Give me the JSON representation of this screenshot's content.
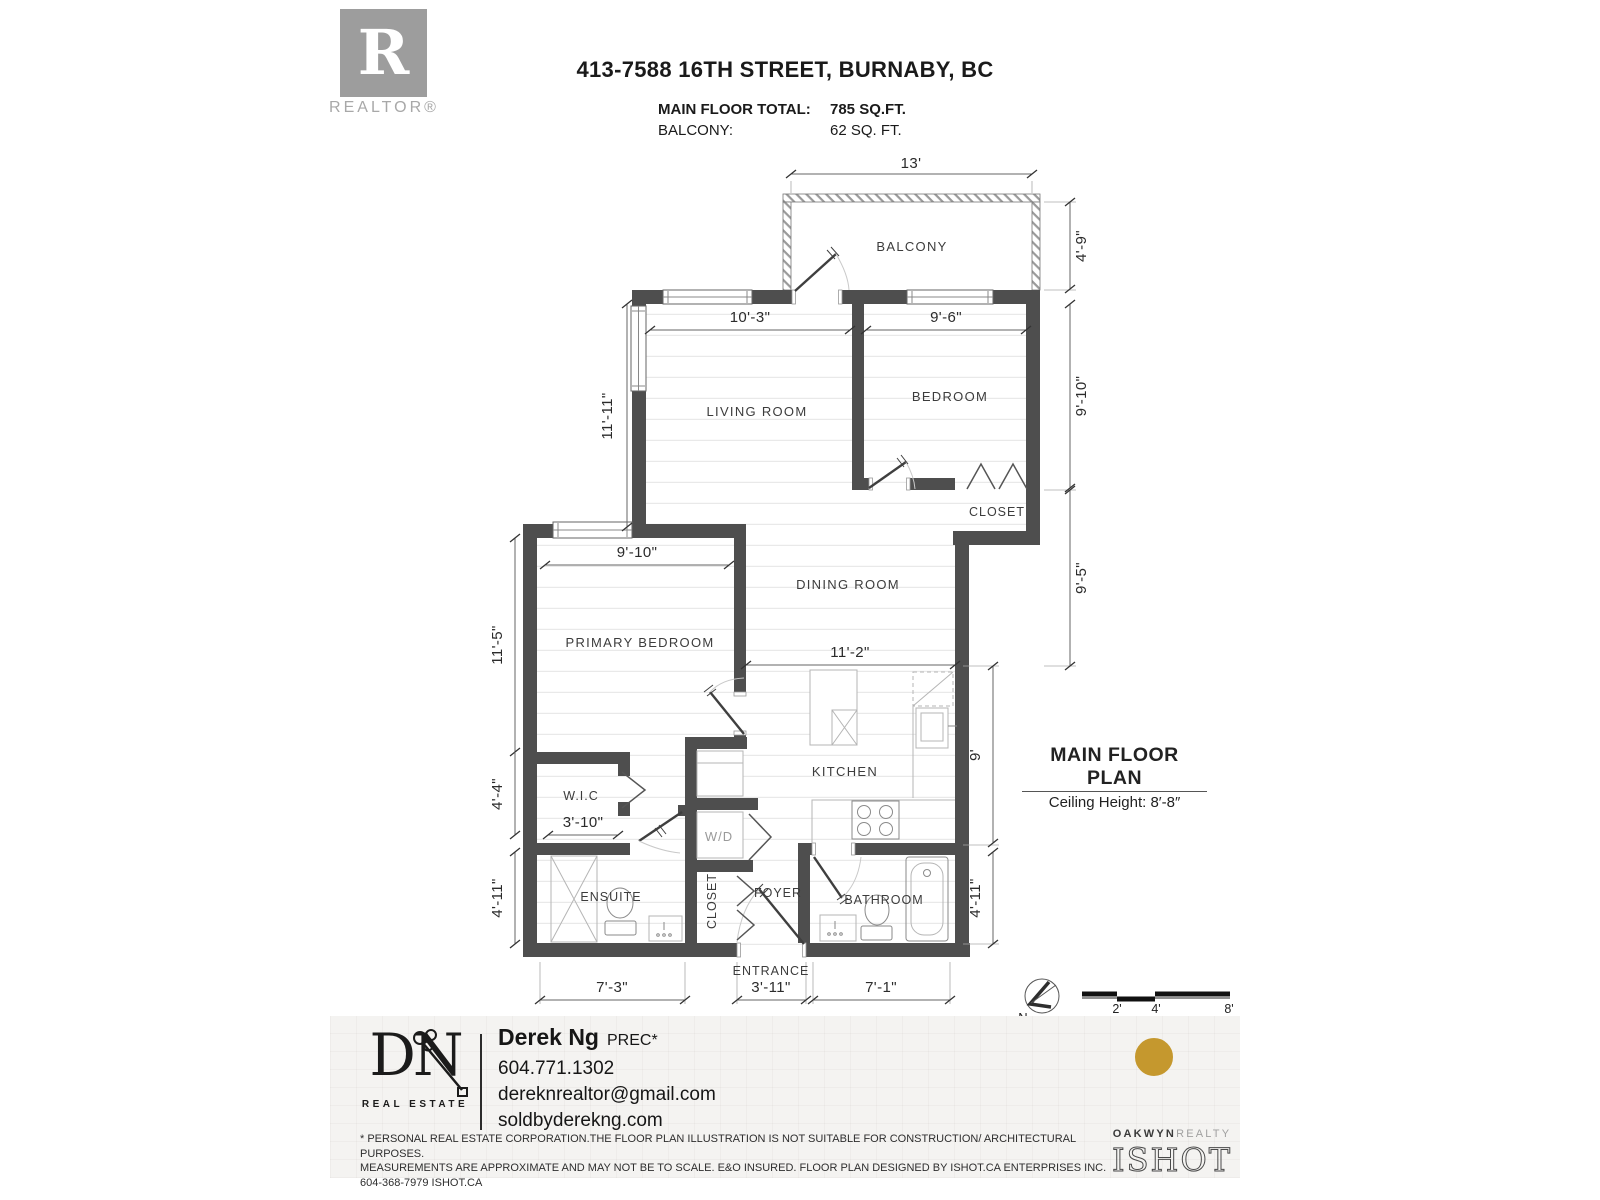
{
  "header": {
    "realtor_logo": {
      "letter": "R",
      "label": "REALTOR®"
    },
    "title": "413-7588 16TH STREET, BURNABY, BC",
    "stats": [
      {
        "label": "MAIN FLOOR TOTAL:",
        "value": "785 SQ.FT."
      },
      {
        "label": "BALCONY:",
        "value": "62 SQ. FT."
      }
    ]
  },
  "plan": {
    "rooms": {
      "balcony": "BALCONY",
      "living": "LIVING ROOM",
      "bedroom": "BEDROOM",
      "bedroom_closet": "CLOSET",
      "dining": "DINING ROOM",
      "primary": "PRIMARY BEDROOM",
      "kitchen": "KITCHEN",
      "wic": "W.I.C",
      "wd": "W/D",
      "ensuite": "ENSUITE",
      "foyer_closet": "CLOSET",
      "foyer": "FOYER",
      "bathroom": "BATHROOM",
      "entrance": "ENTRANCE"
    },
    "dims": {
      "balcony_width": "13'",
      "balcony_depth": "4'-9\"",
      "living_width": "10'-3\"",
      "living_length": "11'-11\"",
      "bedroom_width": "9'-6\"",
      "bedroom_length": "9'-10\"",
      "closet_side": "9'-5\"",
      "primary_width": "9'-10\"",
      "primary_length": "11'-5\"",
      "dining_width": "11'-2\"",
      "kitchen_side": "9'",
      "wic_length": "4'-4\"",
      "wic_width": "3'-10\"",
      "ensuite_length": "4'-11\"",
      "bathroom_length": "4'-11\"",
      "ensuite_width": "7'-3\"",
      "entrance_width": "3'-11\"",
      "bathroom_width": "7'-1\""
    },
    "title": "MAIN FLOOR PLAN",
    "subtitle": "Ceiling Height: 8′-8″",
    "north_label": "N",
    "scale_labels": {
      "two": "2'",
      "four": "4'",
      "eight": "8'"
    }
  },
  "footer": {
    "dn_logo": {
      "monogram": "DN",
      "name": "REAL ESTATE"
    },
    "agent": {
      "name": "Derek Ng",
      "designation": "PREC*",
      "phone": "604.771.1302",
      "email": "dereknrealtor@gmail.com",
      "website": "soldbyderekng.com"
    },
    "disclaimer": [
      "* PERSONAL REAL ESTATE CORPORATION.THE FLOOR PLAN ILLUSTRATION IS NOT SUITABLE FOR CONSTRUCTION/ ARCHITECTURAL PURPOSES.",
      "MEASUREMENTS ARE APPROXIMATE AND MAY NOT BE TO SCALE. E&O INSURED. FLOOR PLAN DESIGNED BY ISHOT.CA ENTERPRISES INC.",
      "604-368-7979  ISHOT.CA"
    ],
    "brokerage": {
      "name": "OAKWYN",
      "suffix": "REALTY"
    },
    "ishot": "ISHOT"
  },
  "colors": {
    "wall": "#4e4e4e",
    "gold": "#c5982e",
    "realtor_gray": "#9d9d9d"
  }
}
